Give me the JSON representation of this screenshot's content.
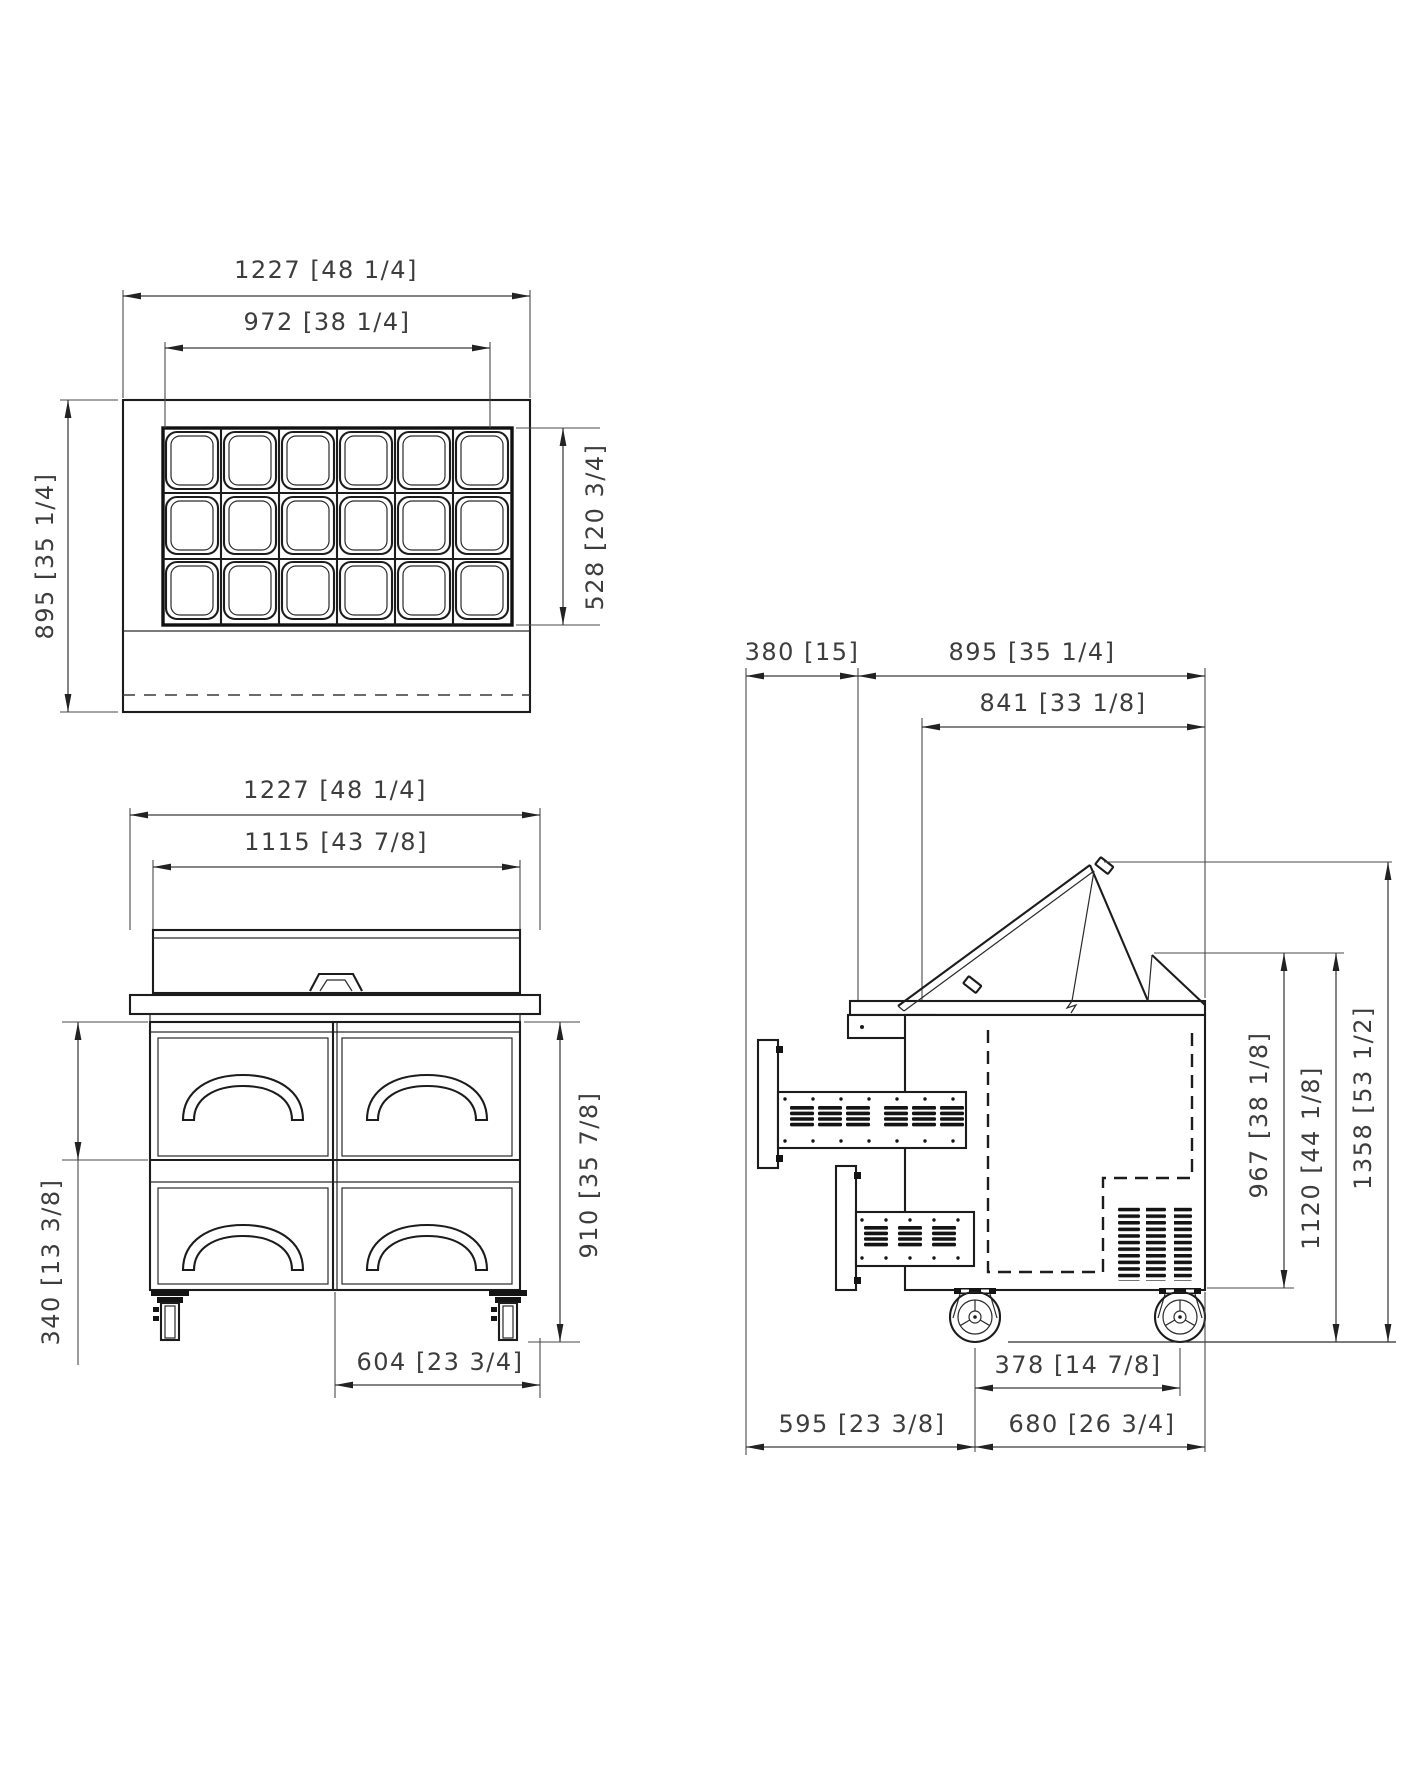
{
  "drawing_type": "spec-sheet three-view technical drawing of a refrigerated sandwich prep table",
  "top_view": {
    "overall_width": "1227 [48 1/4]",
    "pan_opening_width": "972 [38 1/4]",
    "overall_depth": "895 [35 1/4]",
    "pan_opening_depth": "528 [20 3/4]",
    "pan_columns": 6,
    "pan_rows": 3
  },
  "front_view": {
    "overall_width": "1227 [48 1/4]",
    "hood_width": "1115 [43 7/8]",
    "drawer_height": "340 [13 3/8]",
    "work_height": "910 [35 7/8]",
    "caster_span": "604 [23 3/4]",
    "drawer_count": 4
  },
  "side_view": {
    "rear_clearance": "380 [15]",
    "overall_depth": "895 [35 1/4]",
    "hood_depth": "841 [33 1/8]",
    "rail_height": "967 [38 1/8]",
    "closed_lid_height": "1120 [44 1/8]",
    "open_lid_height": "1358 [53 1/2]",
    "caster_span": "378 [14 7/8]",
    "rear_span": "595 [23 3/8]",
    "base_depth": "680 [26 3/4]"
  },
  "colors": {
    "line": "#1c1c1c",
    "dimension_text": "#3d3d3d",
    "background": "#ffffff"
  }
}
